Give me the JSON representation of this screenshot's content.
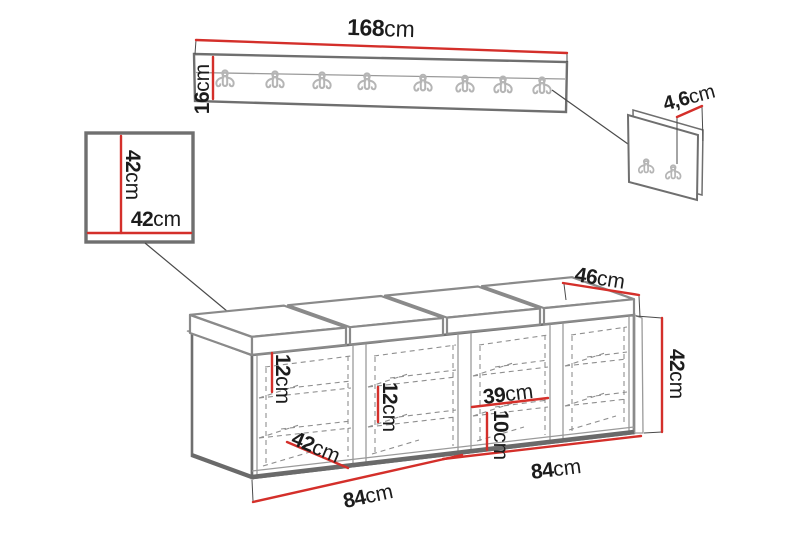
{
  "title": "Hallway furniture set dimension diagram",
  "colors": {
    "dimension_red": "#d42f2a",
    "furniture_gray": "#6f6f6f",
    "text": "#1c1c1c",
    "hook_gray": "#b5b5b5"
  },
  "coat_rack": {
    "width": {
      "value": "168",
      "unit": "cm"
    },
    "height": {
      "value": "16",
      "unit": "cm"
    },
    "hook_count": 8
  },
  "wall_panel": {
    "thickness": {
      "value": "4,6",
      "unit": "cm"
    },
    "hook_count": 2
  },
  "mirror": {
    "height": {
      "value": "42",
      "unit": "cm"
    },
    "width": {
      "value": "42",
      "unit": "cm"
    }
  },
  "bench": {
    "depth": {
      "value": "46",
      "unit": "cm"
    },
    "height": {
      "value": "42",
      "unit": "cm"
    },
    "shelf_gap_1": {
      "value": "12",
      "unit": "cm"
    },
    "shelf_gap_2": {
      "value": "12",
      "unit": "cm"
    },
    "compartment_width": {
      "value": "39",
      "unit": "cm"
    },
    "bottom_gap": {
      "value": "10",
      "unit": "cm"
    },
    "inner_depth": {
      "value": "42",
      "unit": "cm"
    },
    "half_width_left": {
      "value": "84",
      "unit": "cm"
    },
    "half_width_right": {
      "value": "84",
      "unit": "cm"
    },
    "compartment_count": 4,
    "cushion_segments": 4
  }
}
